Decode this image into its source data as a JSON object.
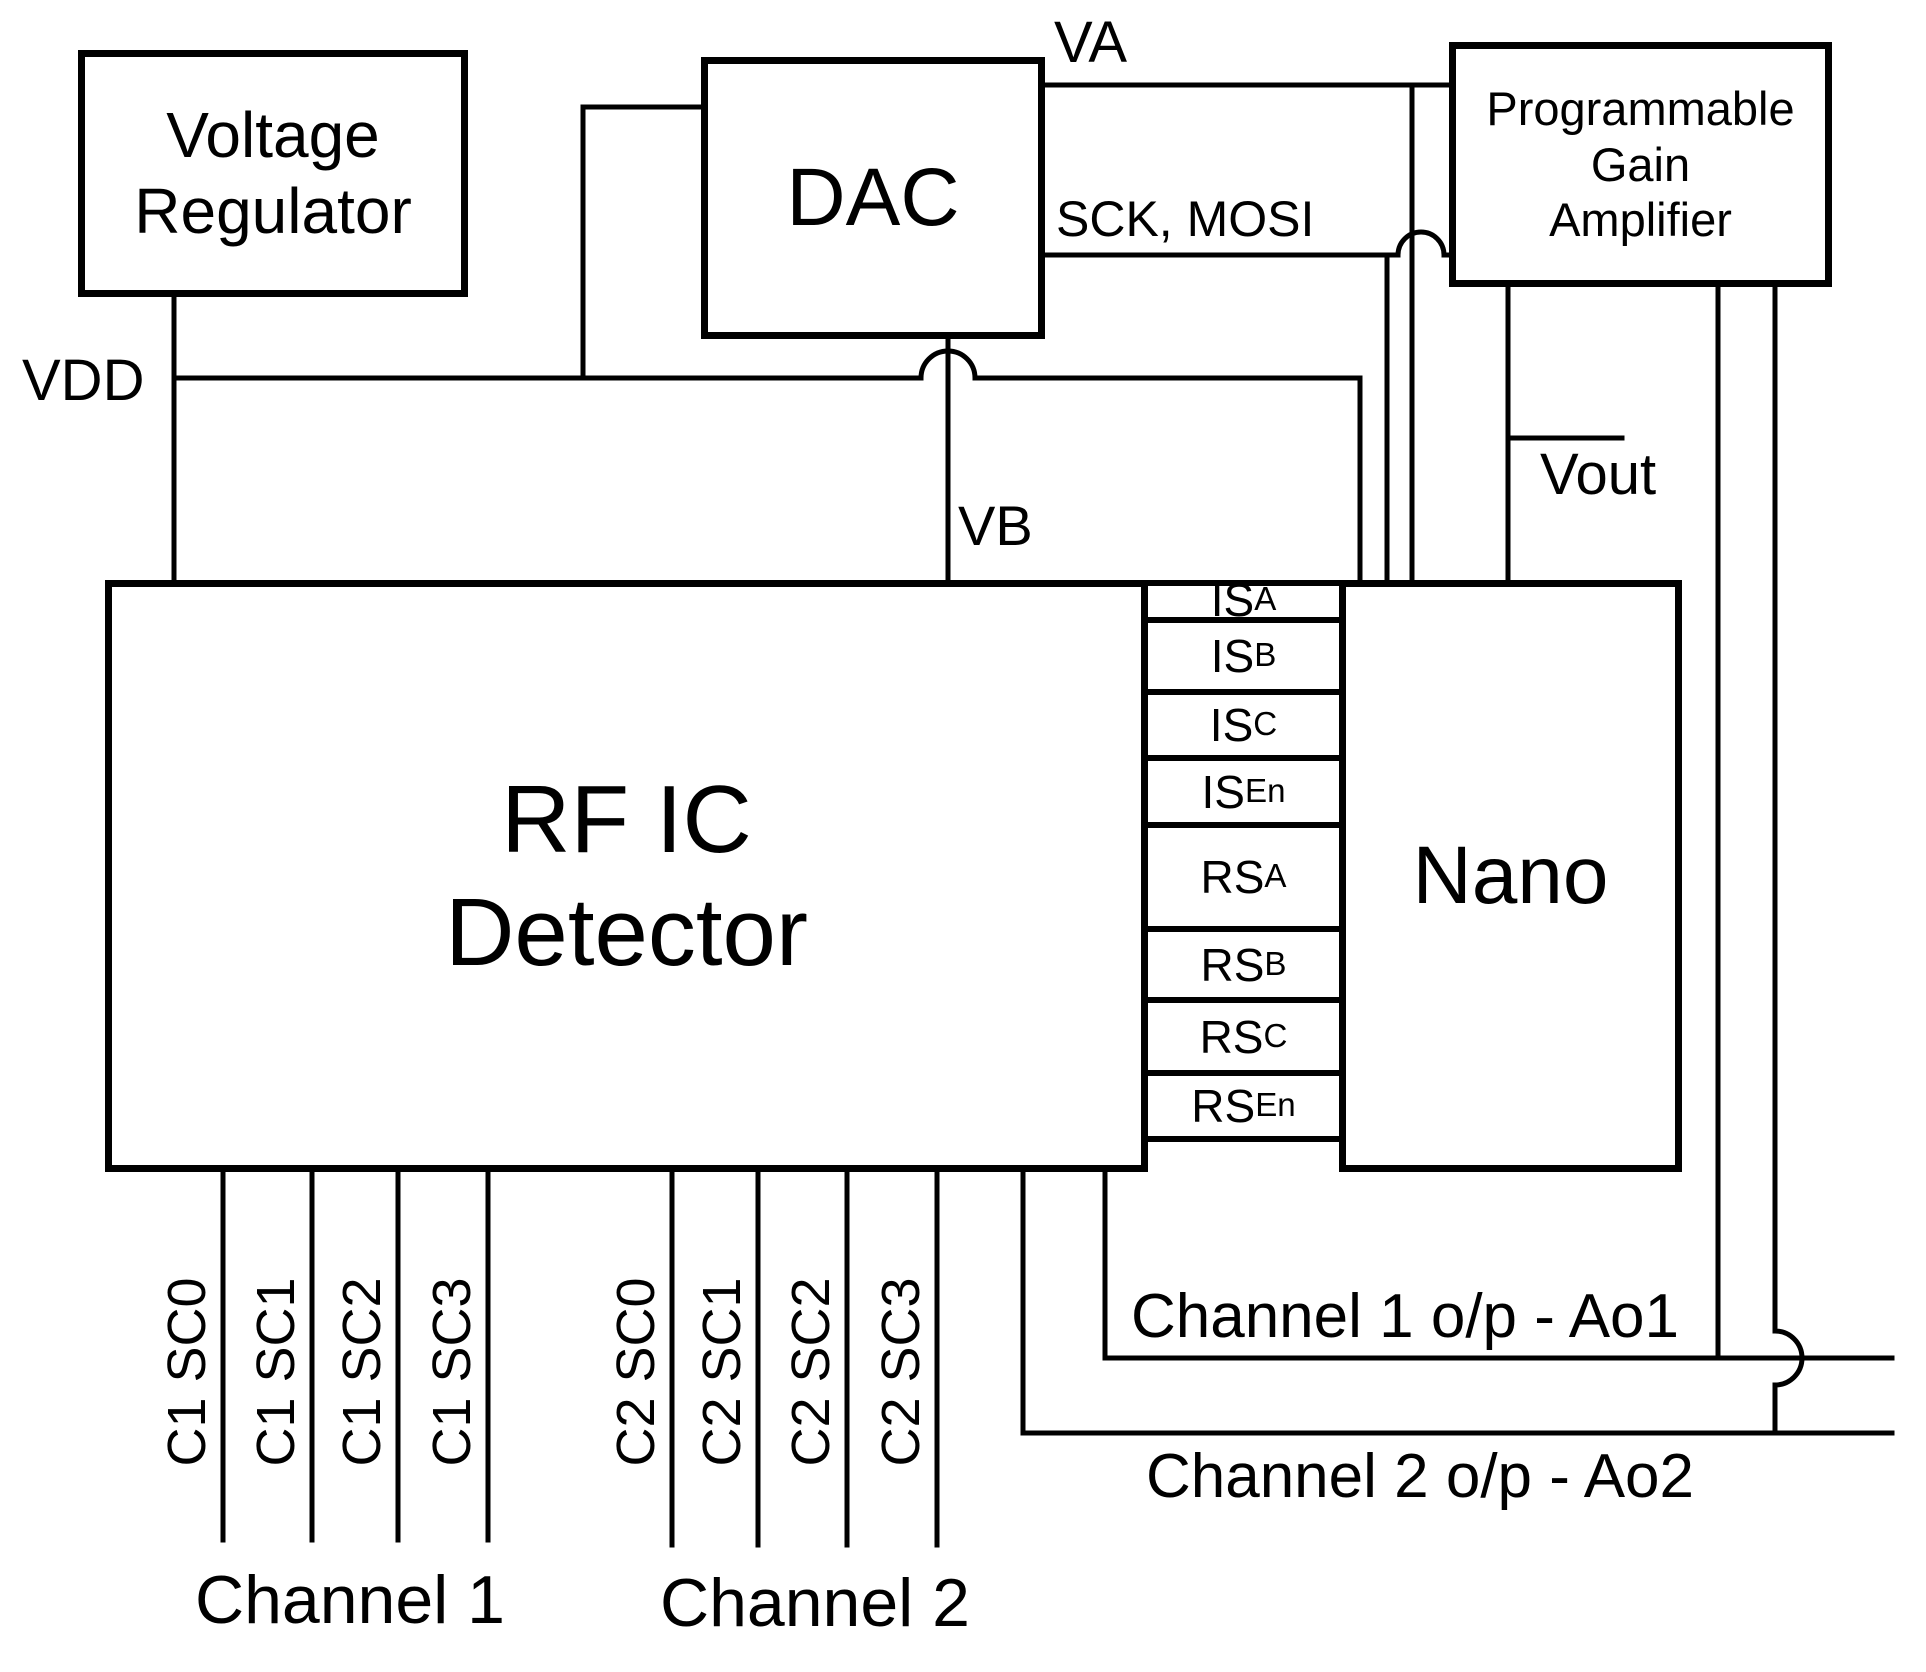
{
  "diagram": {
    "background": "#ffffff",
    "line_color": "#000000",
    "blocks": {
      "voltage_regulator": {
        "line1": "Voltage",
        "line2": "Regulator"
      },
      "dac": {
        "label": "DAC"
      },
      "pga": {
        "line1": "Programmable",
        "line2": "Gain",
        "line3": "Amplifier"
      },
      "rfic": {
        "line1": "RF IC",
        "line2": "Detector"
      },
      "nano": {
        "label": "Nano"
      }
    },
    "nets": {
      "vdd": "VDD",
      "va": "VA",
      "sck_mosi": "SCK, MOSI",
      "vb": "VB",
      "vout": "Vout"
    },
    "bus_signals": [
      {
        "base": "IS",
        "sub": "A"
      },
      {
        "base": "IS",
        "sub": "B"
      },
      {
        "base": "IS",
        "sub": "C"
      },
      {
        "base": "IS",
        "sub": "En"
      },
      {
        "base": "RS",
        "sub": "A"
      },
      {
        "base": "RS",
        "sub": "B"
      },
      {
        "base": "RS",
        "sub": "C"
      },
      {
        "base": "RS",
        "sub": "En"
      }
    ],
    "channel1_pins": [
      "C1 SC0",
      "C1 SC1",
      "C1 SC2",
      "C1 SC3"
    ],
    "channel2_pins": [
      "C2 SC0",
      "C2 SC1",
      "C2 SC2",
      "C2 SC3"
    ],
    "captions": {
      "channel1": "Channel 1",
      "channel2": "Channel 2",
      "channel1_output": "Channel 1 o/p - Ao1",
      "channel2_output": "Channel 2 o/p - Ao2"
    }
  }
}
